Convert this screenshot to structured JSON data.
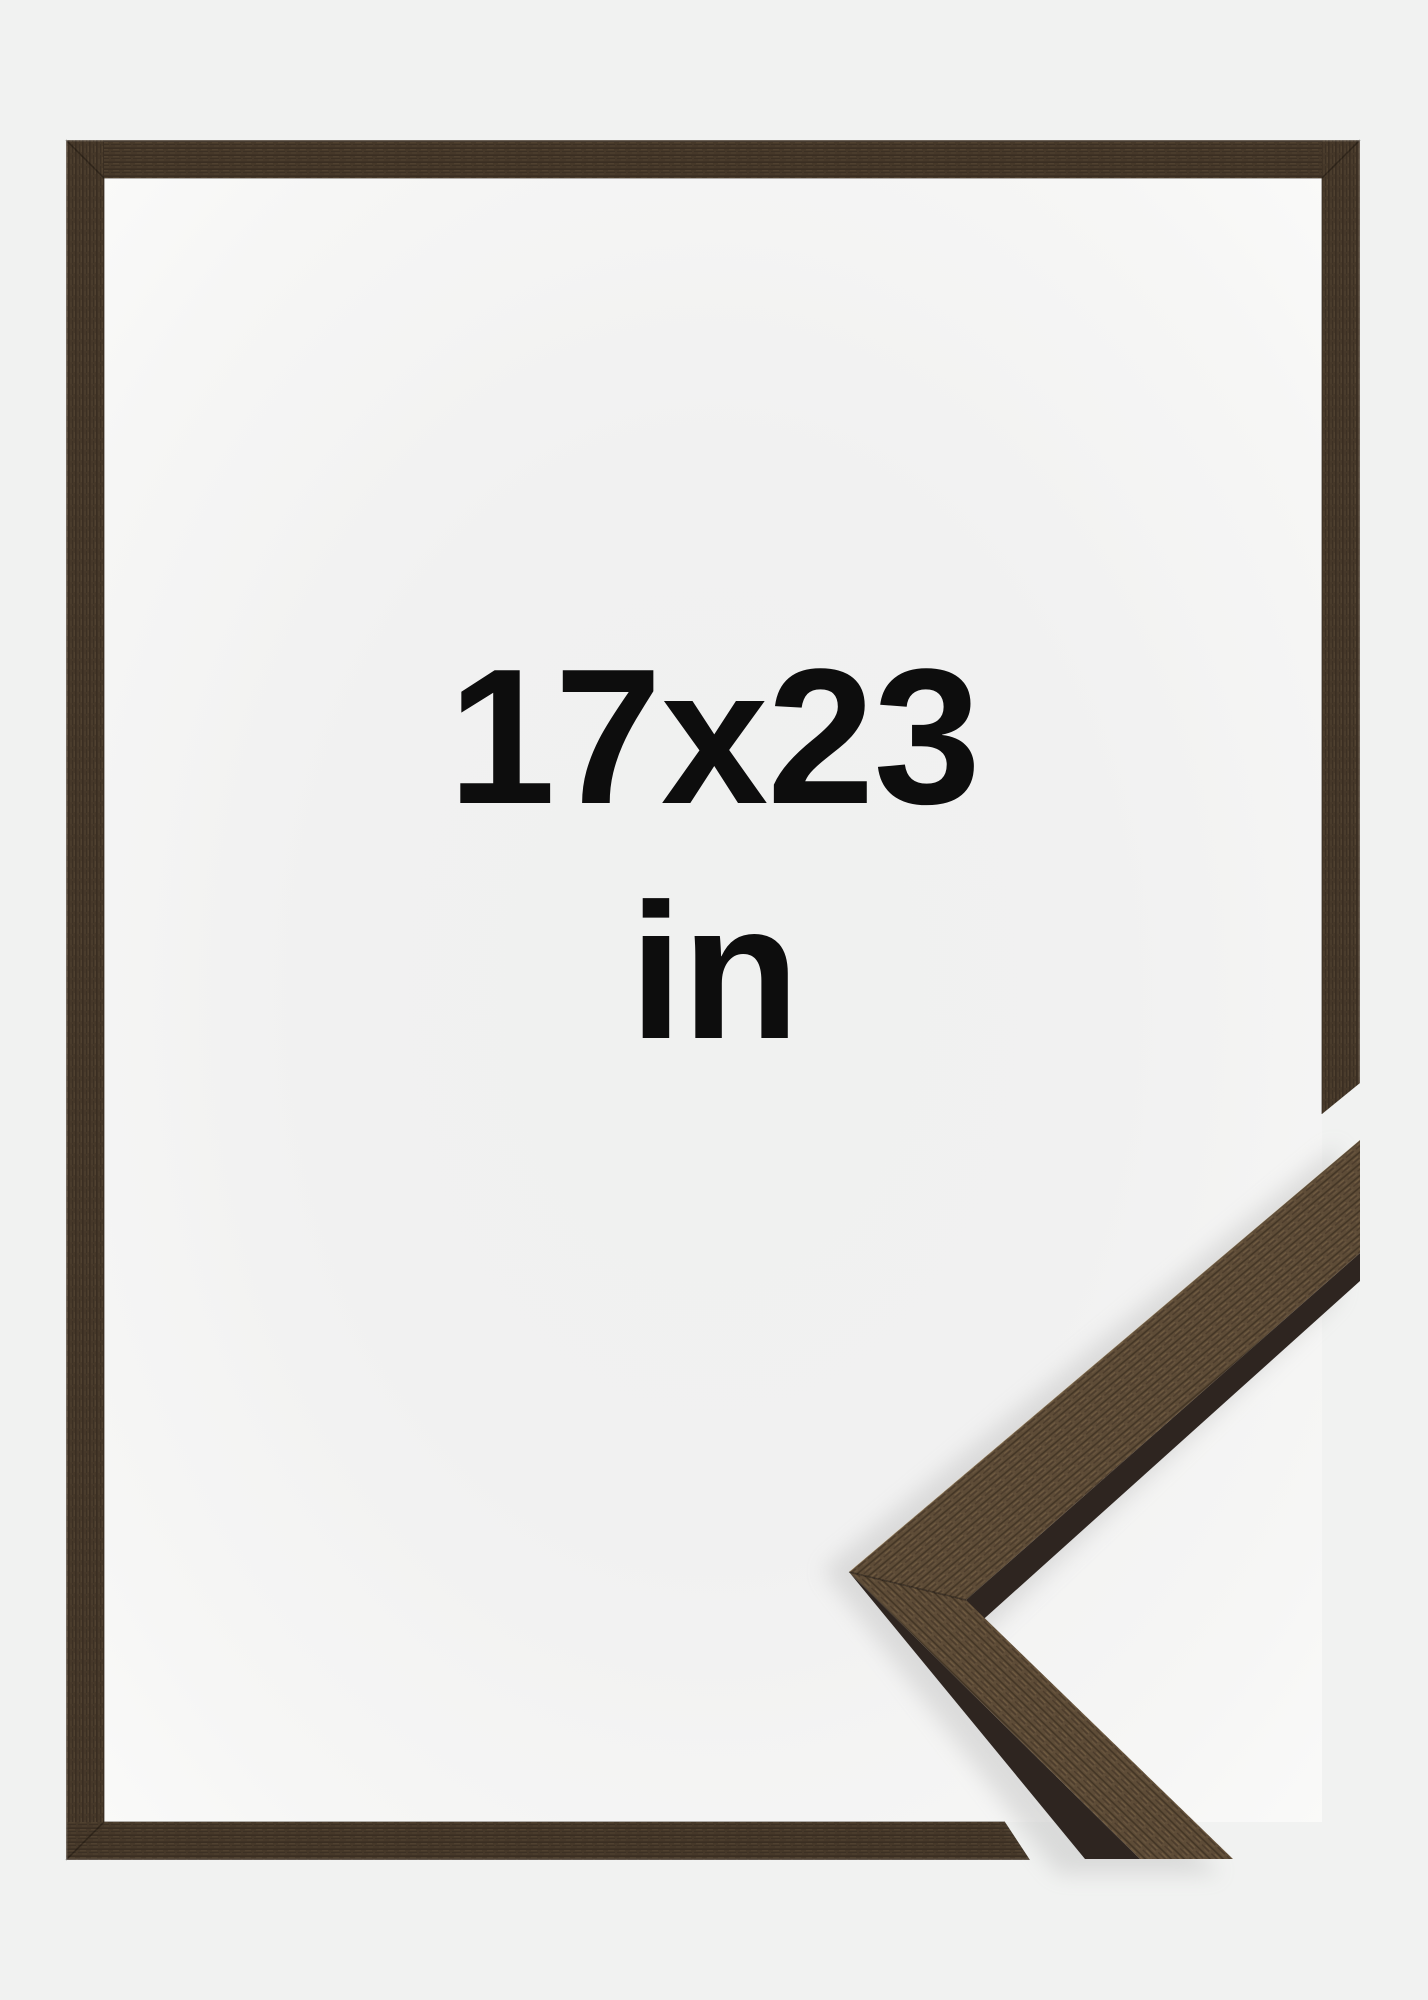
{
  "product_image": {
    "size_label": "17x23",
    "unit_label": "in"
  },
  "colors": {
    "background": "#f1f2f1",
    "frame_wood_base": "#463829",
    "corner_face_wood": "#5e4c37",
    "corner_side_wood": "#2e2520",
    "label_text": "#0d0d0d"
  }
}
